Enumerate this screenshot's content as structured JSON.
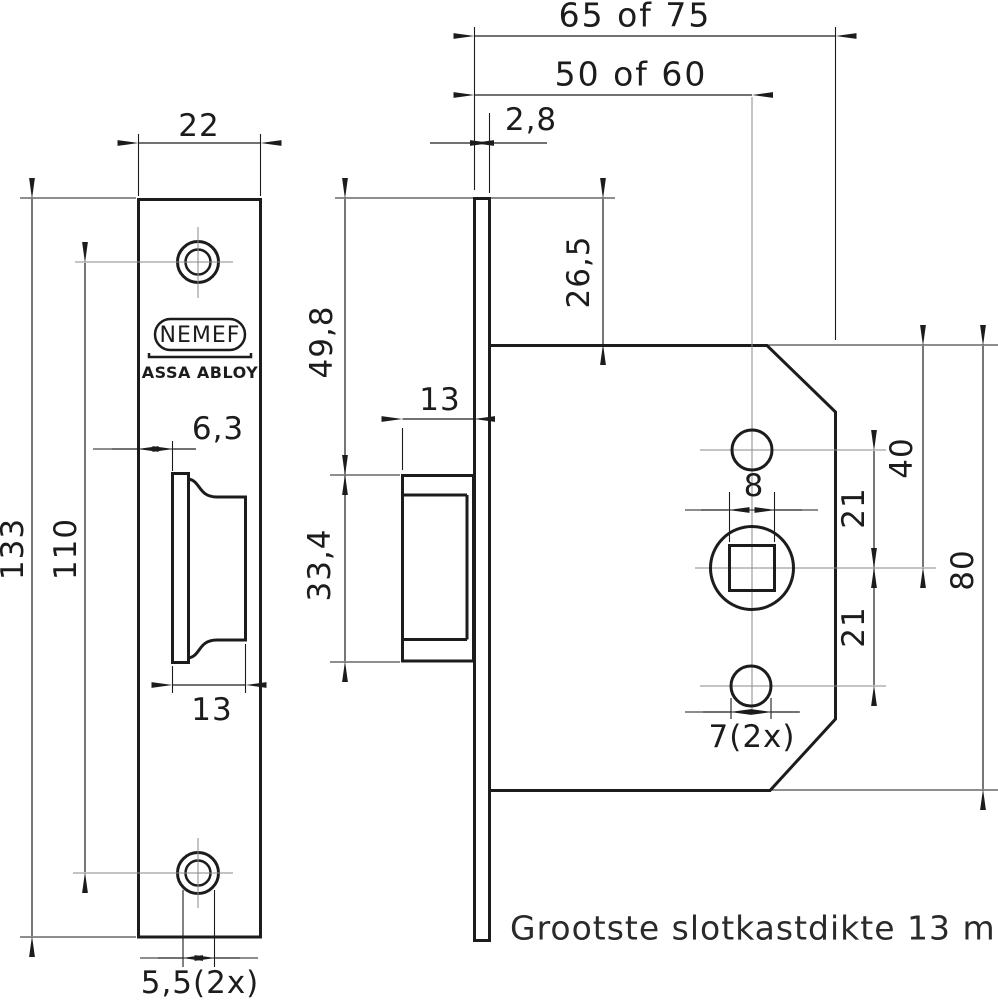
{
  "logo": {
    "brand": "NEMEF",
    "subbrand": "ASSA ABLOY"
  },
  "note": "Grootste slotkastdikte 13 mm",
  "dims": {
    "front_width": "22",
    "front_height": "133",
    "front_hole_spacing": "110",
    "front_bolt_offset": "6,3",
    "front_bolt_width": "13",
    "front_screw_holes": "5,5(2x)",
    "side_plate_thickness": "2,8",
    "side_top_to_bolt": "49,8",
    "side_bolt_height": "33,4",
    "side_bolt_depth": "13",
    "case_depth": "65 of 75",
    "backset": "50 of 60",
    "case_top_margin": "26,5",
    "spindle_square": "8",
    "spindle_from_top": "40",
    "hole_above_spindle": "21",
    "hole_below_spindle": "21",
    "case_height": "80",
    "case_holes": "7(2x)"
  },
  "colors": {
    "line": "#1c1c1c",
    "centerline": "#8a8a8a",
    "background": "#ffffff"
  }
}
